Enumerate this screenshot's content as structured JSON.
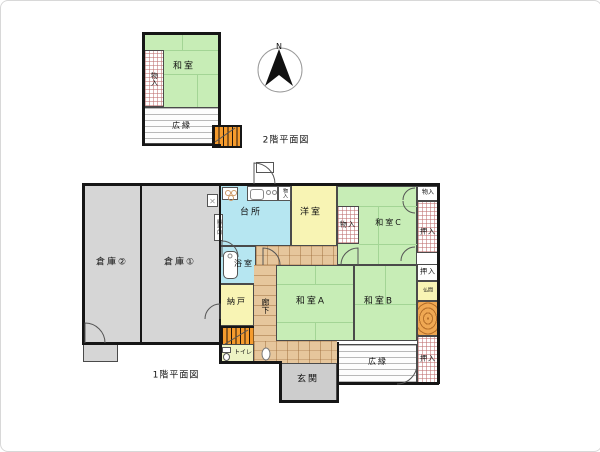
{
  "floor2": {
    "title": "2階平面図",
    "rooms": {
      "washitsu": "和室",
      "monoire": "物入",
      "hiroen": "広縁"
    }
  },
  "compass": {
    "north_label": "N"
  },
  "floor1": {
    "title": "1階平面図",
    "rooms": {
      "souko2": "倉庫②",
      "souko1": "倉庫①",
      "daidokoro": "台所",
      "katteguchi": "勝手口",
      "monoire_kitchen": "物入",
      "yoshitsu": "洋室",
      "monoire_c": "物入",
      "washitsu_c": "和室C",
      "monoire_ne": "物入",
      "oshiire_e1": "押入",
      "oshiire_e2": "押入",
      "butsuma": "仏間",
      "oshiire_se": "押入",
      "yokushitsu": "浴室",
      "nando": "納戸",
      "rouka": "廊下",
      "washitsu_a": "和室A",
      "washitsu_b": "和室B",
      "hiroen": "広縁",
      "toire": "トイレ",
      "genkan": "玄関"
    }
  },
  "colors": {
    "tatami_green": "#c7edb6",
    "water_cyan": "#b6e6f1",
    "room_yellow": "#f8f4b4",
    "warehouse_gray": "#d6d6d6",
    "wood_floor": "#e6c69c",
    "stair_orange": "#f59b2d",
    "closet_hatch": "#be6e6e",
    "wall_black": "#161616"
  }
}
